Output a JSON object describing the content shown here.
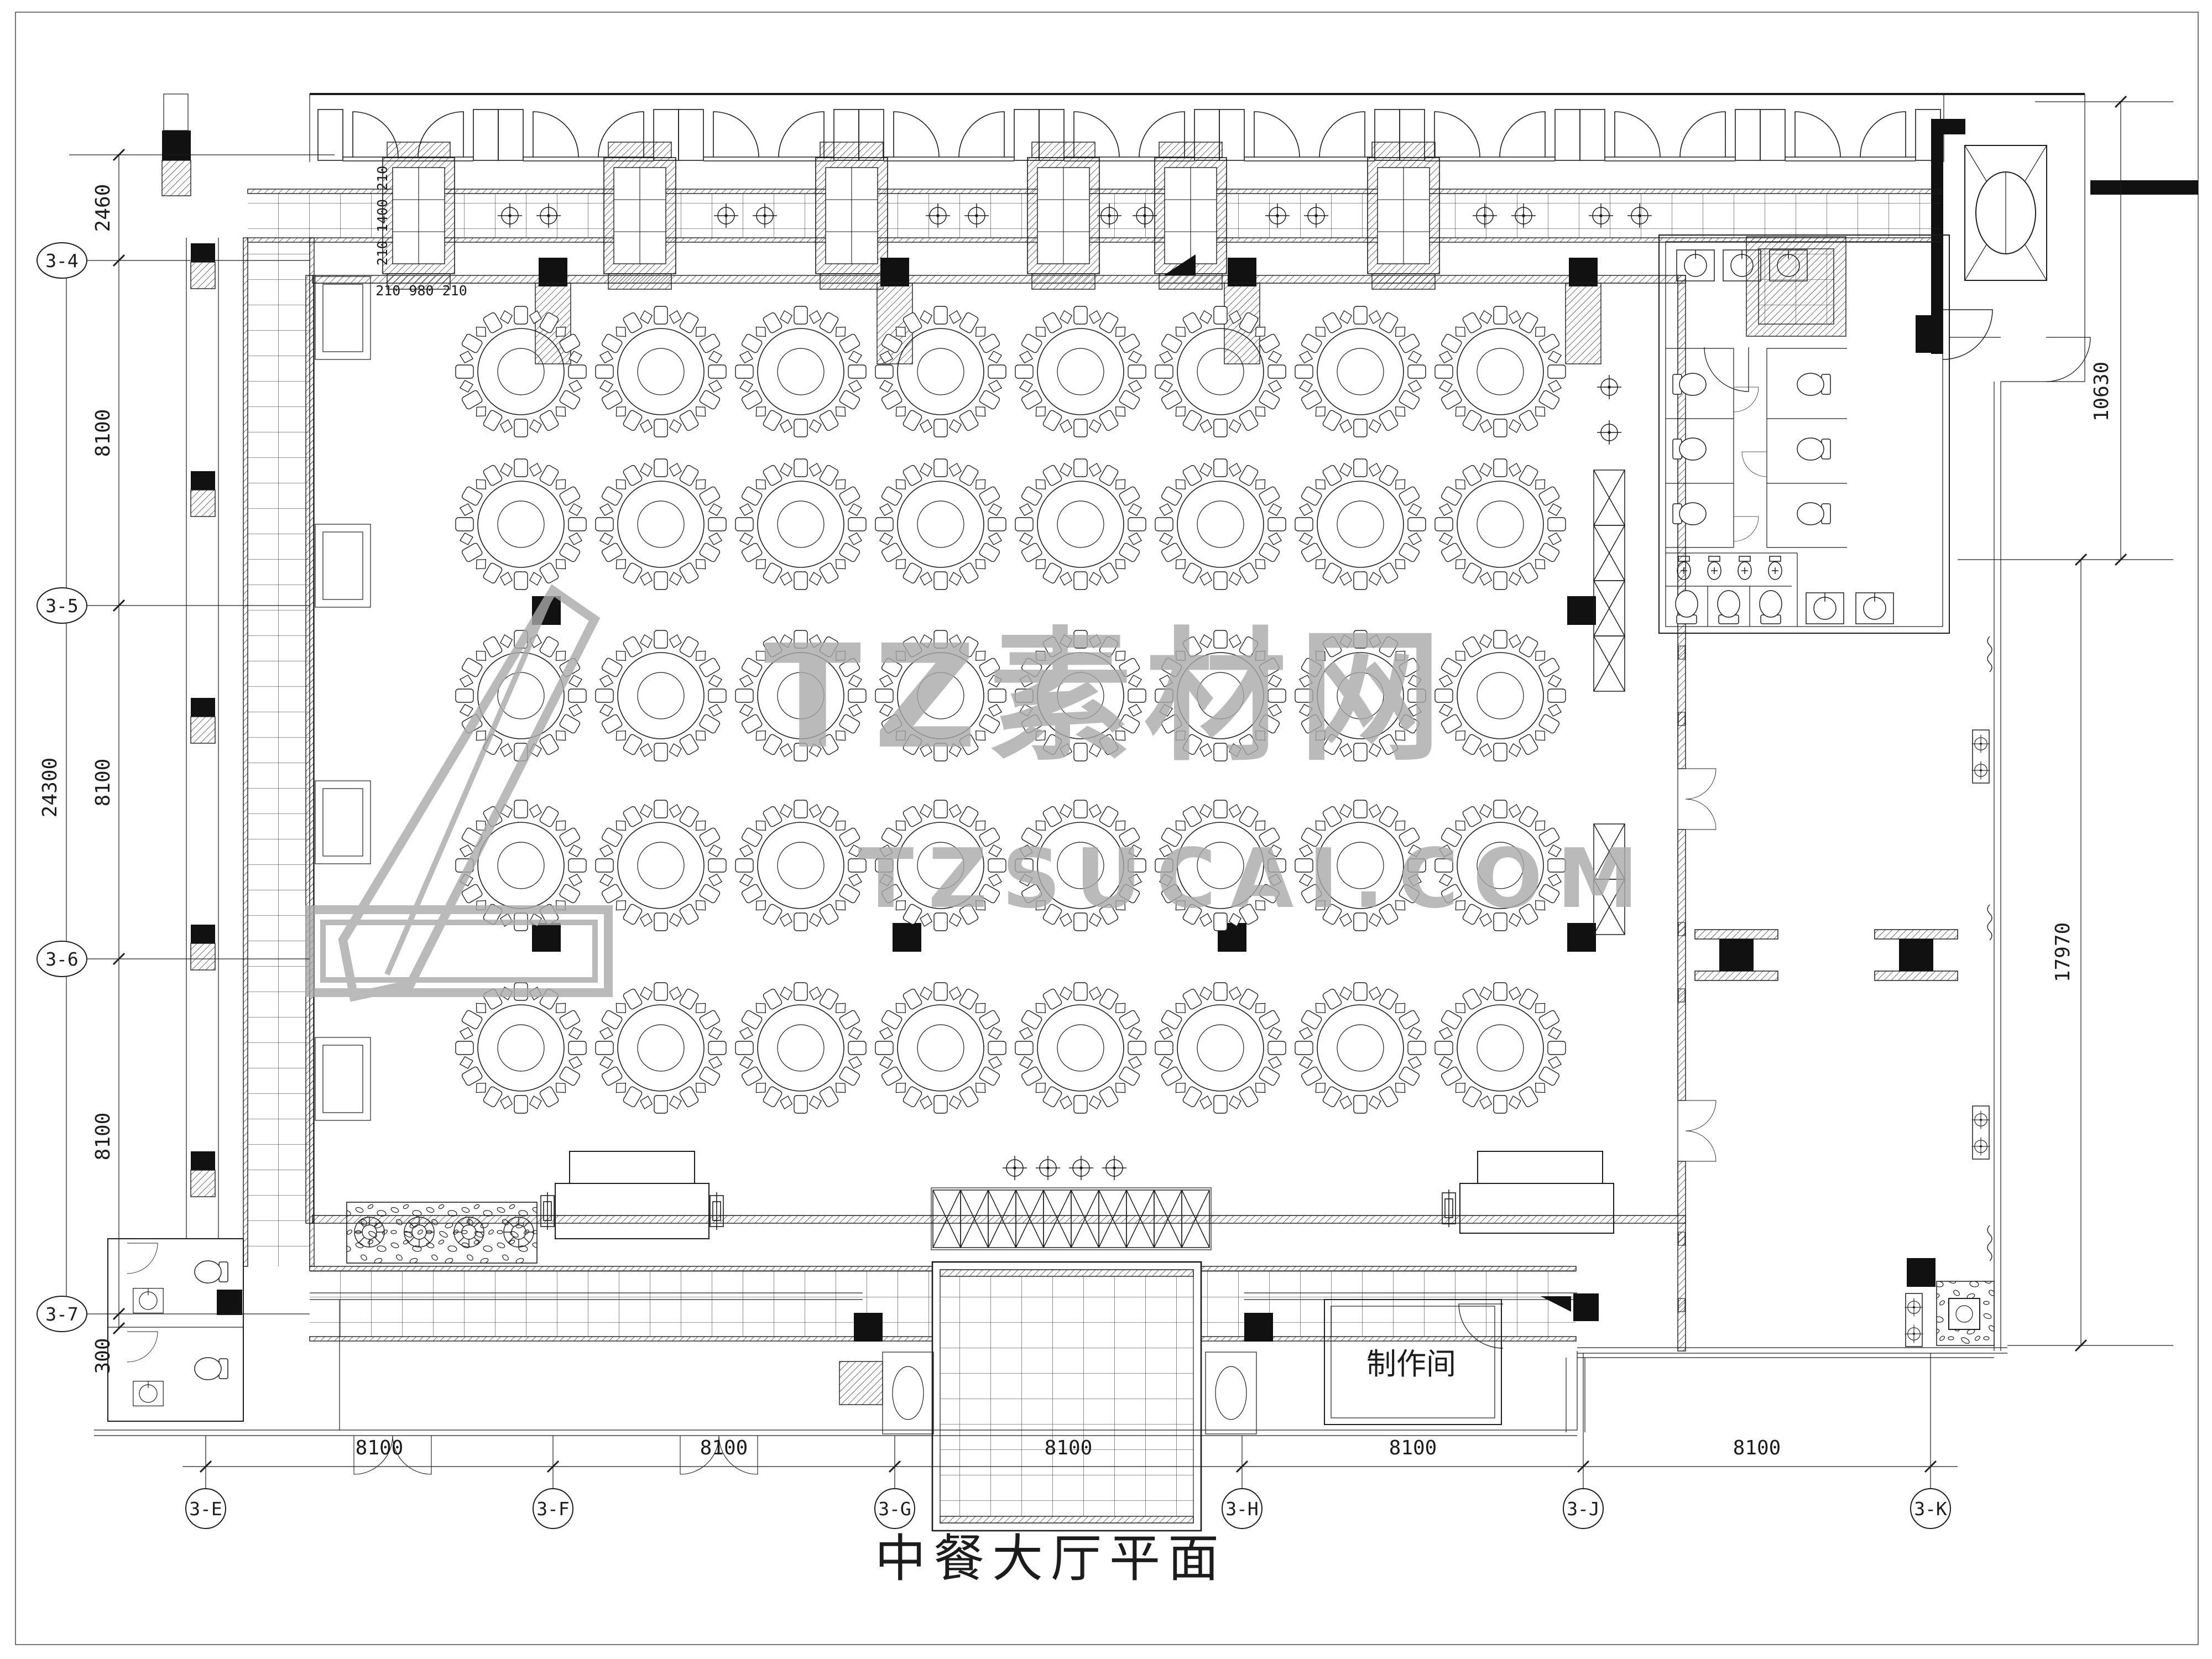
{
  "title": "中餐大厅平面",
  "watermark": {
    "brand": "TZ素材网",
    "site": "TZSUCAI.COM"
  },
  "labels": {
    "production_room": "制作间"
  },
  "grid_bubbles": {
    "left": [
      "3-4",
      "3-5",
      "3-6",
      "3-7"
    ],
    "bottom": [
      "3-E",
      "3-F",
      "3-G",
      "3-H",
      "3-J",
      "3-K"
    ]
  },
  "dimensions": {
    "left_chain": [
      "2460",
      "8100",
      "8100",
      "8100",
      "300"
    ],
    "left_overall": "24300",
    "bottom_chain": [
      "8100",
      "8100",
      "8100",
      "8100",
      "8100"
    ],
    "right_upper": "10630",
    "right_lower": "17970",
    "column_detail_vertical": "210 1400 210",
    "column_detail_horizontal": "210 980 210"
  },
  "colors": {
    "line": "#1c1c1c",
    "solid_fill": "#111111",
    "watermark": "#a9a9a9",
    "paper": "#ffffff"
  }
}
